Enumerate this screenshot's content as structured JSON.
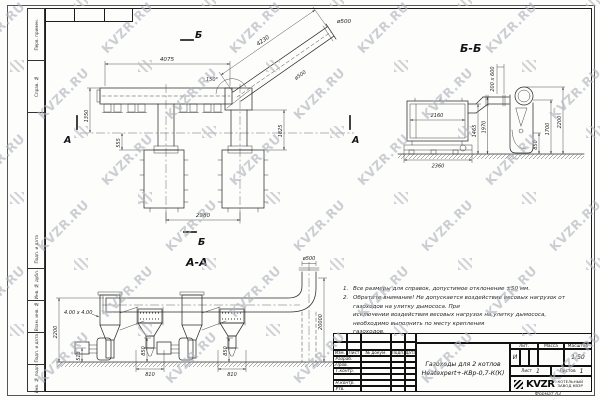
{
  "watermark": {
    "text": "KVZR.RU"
  },
  "frame": {
    "format_label": "Формат А3",
    "side_labels": [
      "Перв. примен.",
      "Справ. №",
      "Подп. и дата",
      "Инв. № дубл.",
      "Взам. инв. №",
      "Подп. и дата",
      "Инв. № подл."
    ]
  },
  "plan": {
    "section_b": "Б",
    "section_a": "А",
    "dim_header_len": "4075",
    "dim_incline_len": "4230",
    "dim_incline_dia": "ø500",
    "dim_outlet_dia": "ø500",
    "dim_angle": "150°",
    "dim_left_h": "1350",
    "dim_left_offset": "555",
    "dim_right_offset": "1825",
    "dim_boiler_spacing": "2980"
  },
  "section_bb": {
    "title": "Б-Б",
    "dim_duct": "200 x 600",
    "dim_boiler_w": "2160",
    "dim_base_w": "2360",
    "dim_h1": "1465",
    "dim_h2": "1970",
    "dim_h3": "850",
    "dim_h4": "1700",
    "dim_h5": "2200"
  },
  "section_aa": {
    "title": "А-А",
    "dim_duct_size": "4.00 x 4.00",
    "dim_height": "2200",
    "dim_fan_h": "513",
    "dim_cyclone_h": "850",
    "dim_cyclone_w": "810",
    "dim_chimney_dia": "ø500",
    "dim_chimney_h": "20000"
  },
  "notes": {
    "n1_num": "1.",
    "n1": "Все размеры для справок, допустимое отклонение ±50 мм.",
    "n2_num": "2.",
    "n2_l1": "Обратите внимание! Не допускается воздействие весовых нагрузок от газоходов на улитку дымососа. При",
    "n2_l2": "исключении воздействия весовых нагрузок на улитку дымососа, необходимо выполнить по месту крепления",
    "n2_l3": "газоходов."
  },
  "title_block": {
    "doc_title_1": "Газоходы для 2 котлов",
    "doc_title_2": "Heatexpert+-КВр-0,7-К(К)",
    "col_izm": "Изм.",
    "col_list": "Лист",
    "col_doc": "№ докум.",
    "col_sign": "Подп.",
    "col_date": "Дата",
    "row_razrab": "Разраб.",
    "row_prov": "Пров.",
    "row_tkontr": "Т.контр.",
    "row_nkontr": "Н.контр.",
    "row_utv": "Утв.",
    "lit_label": "Лит.",
    "mass_label": "Масса",
    "scale_label": "Масштаб",
    "lit_value": "И",
    "scale_value": "1:50",
    "sheet_label": "Лист",
    "sheet_value": "1",
    "sheets_label": "Листов",
    "sheets_value": "1",
    "logo_text": "KVZR",
    "company_line1": "КОТЕЛЬНЫЙ",
    "company_line2": "ЗАВОД КВЗР"
  }
}
